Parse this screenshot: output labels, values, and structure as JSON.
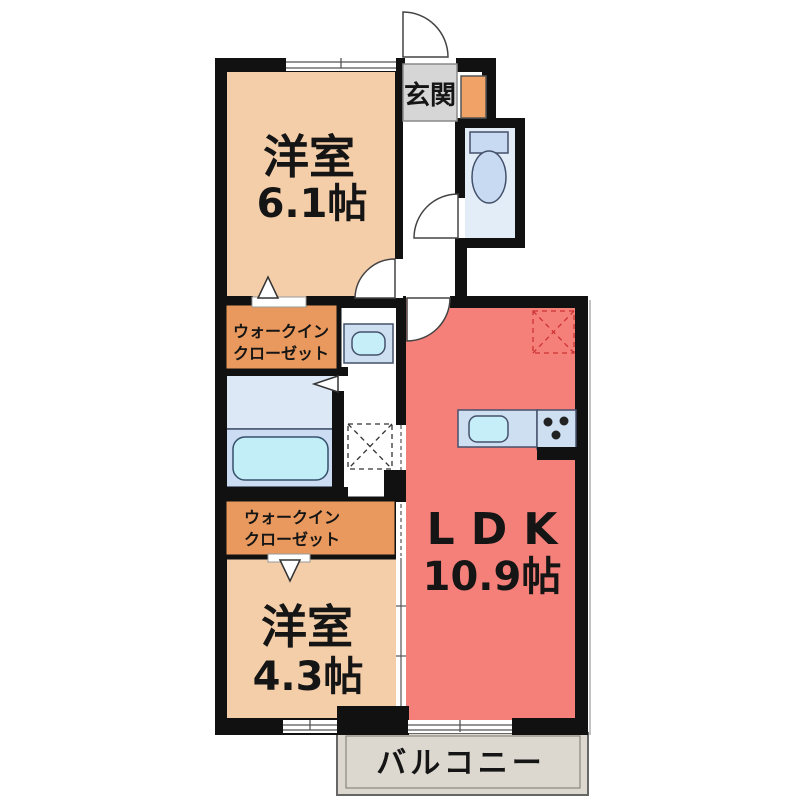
{
  "floorplan": {
    "entrance": {
      "label": "玄関"
    },
    "bedroom_top": {
      "name": "洋室",
      "area": "6.1帖"
    },
    "bedroom_bottom": {
      "name": "洋室",
      "area": "4.3帖"
    },
    "ldk": {
      "name": "LDK",
      "area": "10.9帖"
    },
    "closet_top": {
      "line1": "ウォークイン",
      "line2": "クローゼット"
    },
    "closet_bottom": {
      "line1": "ウォークイン",
      "line2": "クローゼット"
    },
    "balcony": {
      "label": "バルコニー"
    },
    "colors": {
      "wall": "#111111",
      "bedroom": "#f4cda9",
      "closet": "#e9995d",
      "shoe_cabinet": "#f1a367",
      "ldk": "#f5807a",
      "bath_upper": "#dce8f6",
      "bath_lower": "#ccdcf2",
      "tub": "#c2eef8",
      "toilet_room": "#e3edf8",
      "fixture_blue": "#c7daf2",
      "counter": "#cfdff2",
      "sink": "#c6eef8",
      "entrance_box": "#d6d6d6",
      "balcony_floor": "#dcd7cf",
      "fridge_dash": "#cc3333"
    }
  }
}
